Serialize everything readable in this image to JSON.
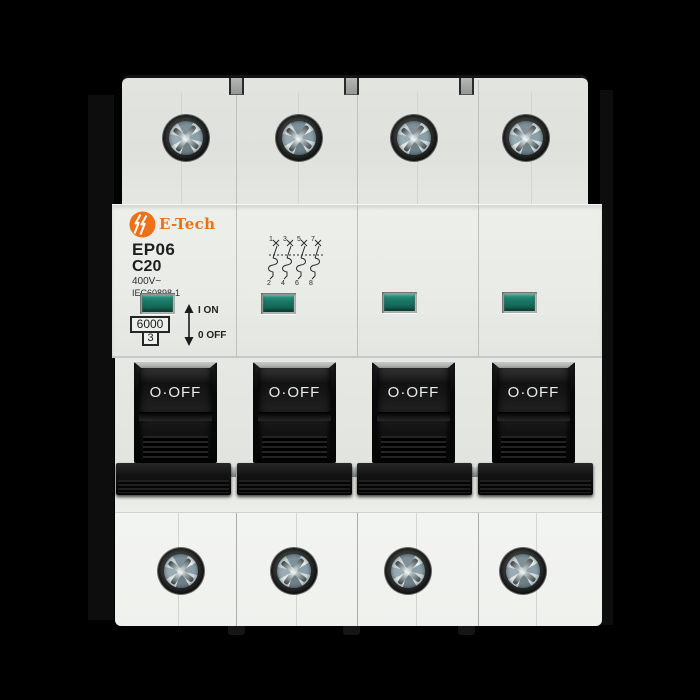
{
  "device": {
    "brand": "E-Tech",
    "model": "EP06",
    "current_rating": "C20",
    "voltage_rating": "400V~",
    "standard": "IEC60898-1",
    "breaking_capacity": "6000",
    "energy_limiting_class": "3",
    "on_marking": "I ON",
    "off_marking": "0 OFF",
    "poles": 4
  },
  "switch": {
    "handle_labels": [
      "O·OFF",
      "O·OFF",
      "O·OFF",
      "O·OFF"
    ]
  },
  "wiring_diagram": {
    "top_terminals": [
      "1",
      "3",
      "5",
      "7"
    ],
    "bottom_terminals": [
      "2",
      "4",
      "6",
      "8"
    ]
  },
  "colors": {
    "background": "#000000",
    "body": "#e9ebe7",
    "handle_black": "#141414",
    "indicator_green": "#15705f",
    "brand_orange": "#ee7117"
  }
}
